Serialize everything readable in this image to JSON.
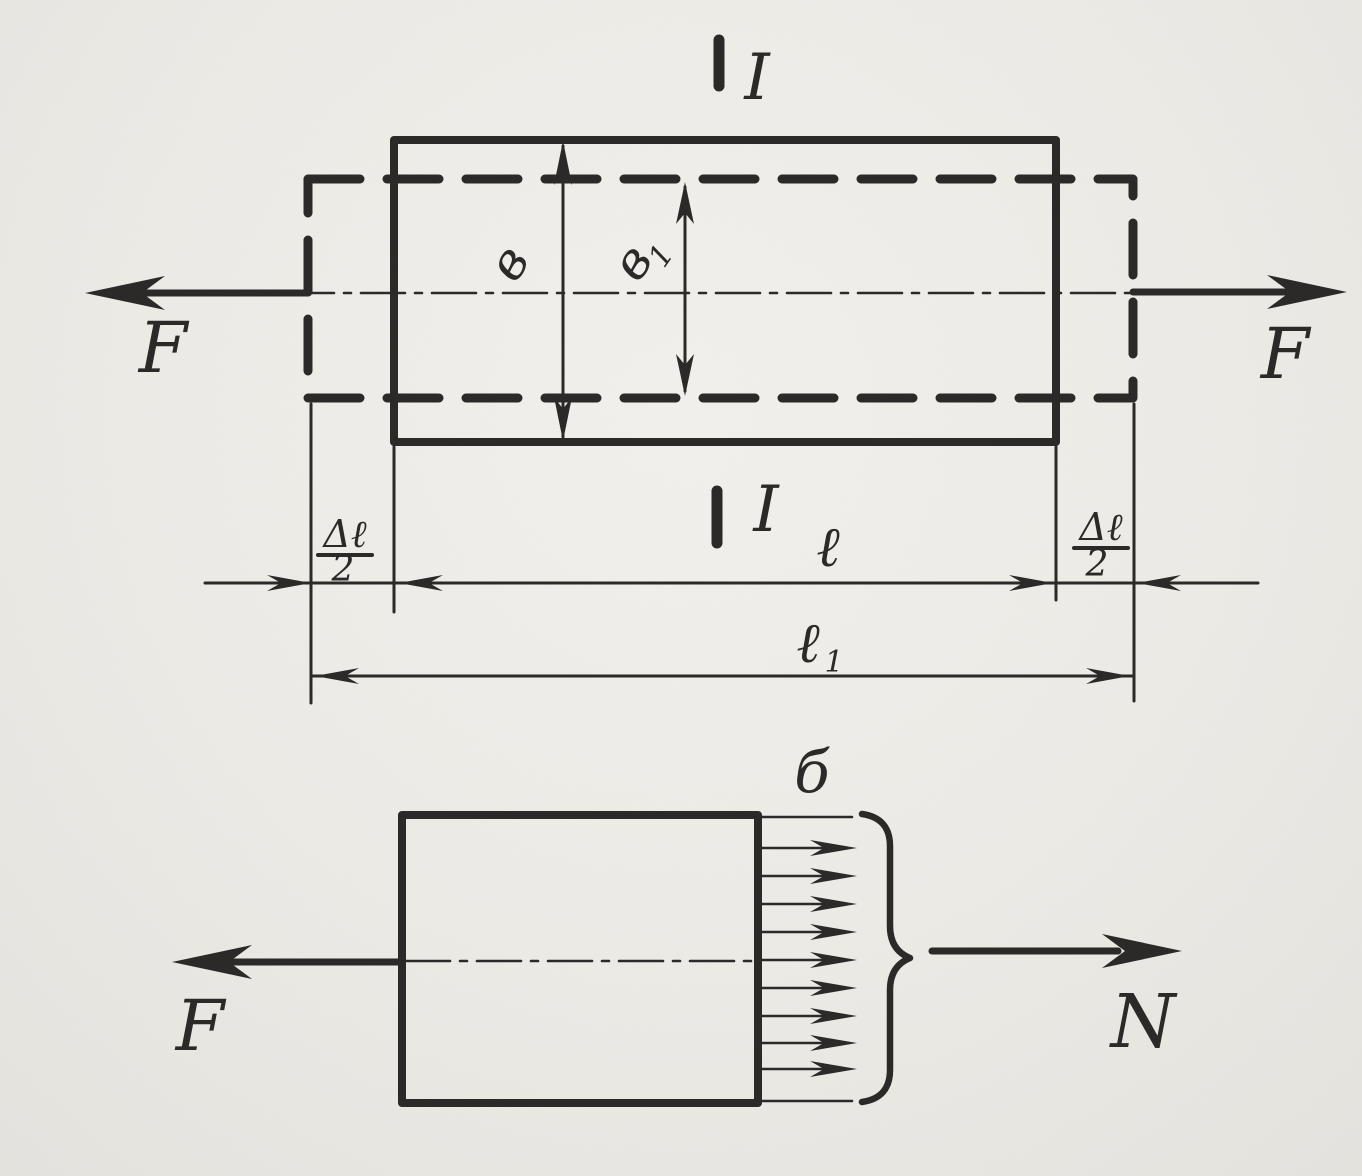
{
  "page": {
    "paper_color": "#edebe6",
    "ink_color": "#2b2a28"
  },
  "top_view": {
    "section_marker_top": "I",
    "section_marker_bottom": "I",
    "force_left": "F",
    "force_right": "F",
    "width_original": "в",
    "width_deformed_base": "в",
    "width_deformed_sub": "1",
    "elongation_left_numerator": "Δℓ",
    "elongation_left_denominator": "2",
    "elongation_right_numerator": "Δℓ",
    "elongation_right_denominator": "2",
    "length_original": "ℓ",
    "length_total_base": "ℓ",
    "length_total_sub": "1"
  },
  "bottom_view": {
    "force_left": "F",
    "stress_label": "б",
    "normal_force": "N"
  }
}
